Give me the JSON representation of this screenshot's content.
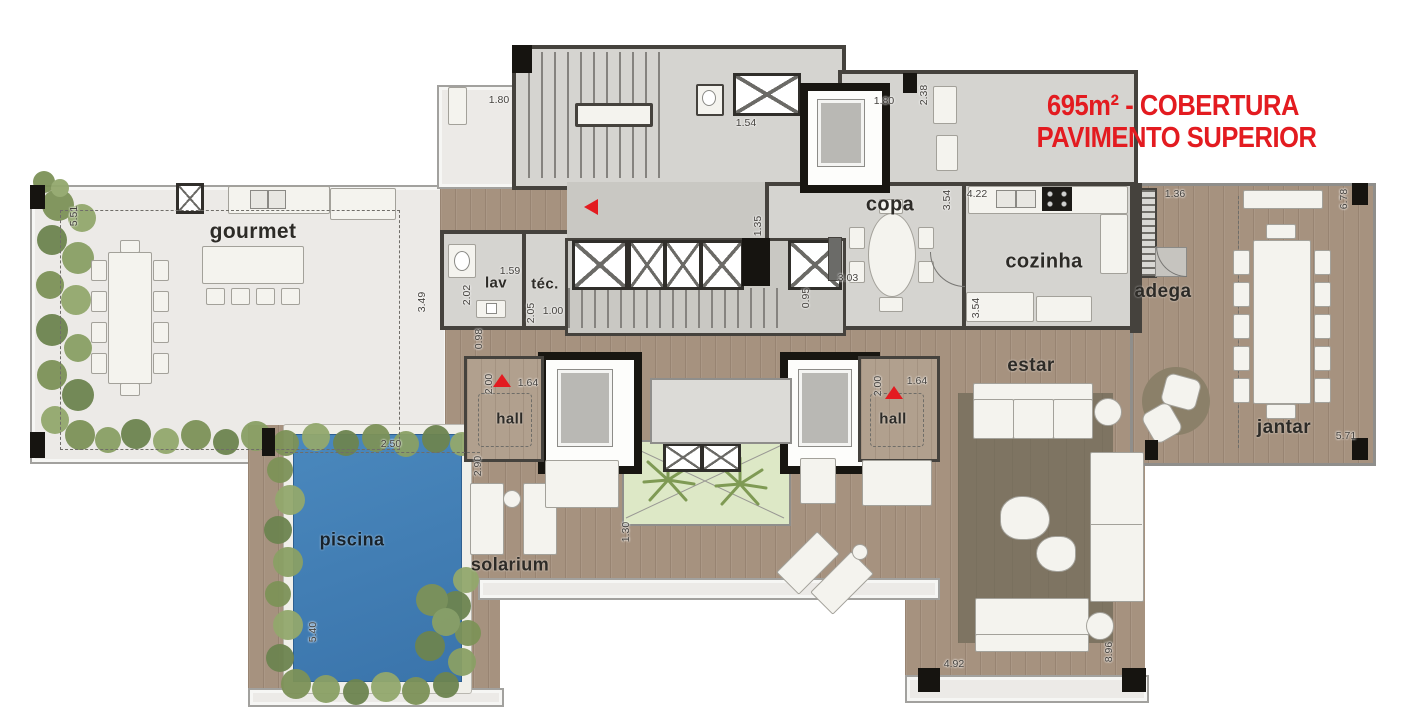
{
  "title": {
    "line1": "695m² - COBERTURA",
    "line2": "PAVIMENTO SUPERIOR"
  },
  "rooms": {
    "gourmet": "gourmet",
    "lav": "lav",
    "tec": "téc.",
    "copa": "copa",
    "cozinha": "cozinha",
    "adega": "adega",
    "jantar": "jantar",
    "hall_left": "hall",
    "hall_right": "hall",
    "estar": "estar",
    "piscina": "piscina",
    "solarium": "solarium"
  },
  "dims": {
    "d551": "5.51",
    "d349": "3.49",
    "d180a": "1.80",
    "d154": "1.54",
    "d180b": "1.80",
    "d238": "2.38",
    "d422": "4.22",
    "d354a": "3.54",
    "d354b": "3.54",
    "d303": "3.03",
    "d135": "1.35",
    "d095": "0.95",
    "d159": "1.59",
    "d202": "2.02",
    "d205": "2.05",
    "d100": "1.00",
    "d098": "0.98",
    "d200a": "2.00",
    "d164a": "1.64",
    "d200b": "2.00",
    "d164b": "1.64",
    "d290": "2.90",
    "d250": "2.50",
    "d540": "5.40",
    "d130": "1.30",
    "d136": "1.36",
    "d678": "6.78",
    "d571": "5.71",
    "d492": "4.92",
    "d896": "8.96"
  },
  "colors": {
    "accent_red": "#e31b20",
    "pool_blue": "#3d79b0",
    "deck_wood": "#a6927f",
    "interior_gray": "#d5d4d0",
    "wall_dark": "#45423d",
    "rug_brown": "#7e7462",
    "greenery": "#7d9258",
    "atrium_green": "#dde8c6"
  }
}
